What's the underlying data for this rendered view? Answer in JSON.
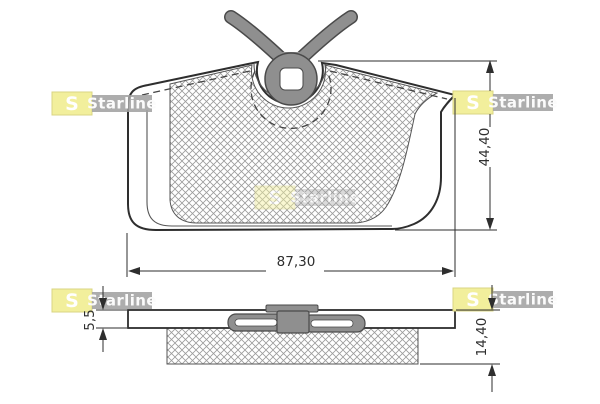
{
  "diagram": {
    "type": "brake-pad technical drawing, front view and side view",
    "dimensions": {
      "width_label": "87,30",
      "height_label": "44,40",
      "backplate_thickness_label": "5,5",
      "total_thickness_label": "14,40"
    },
    "brand": {
      "initial": "S",
      "name": "Starline"
    },
    "colors": {
      "accent-yellow": "#f2ef9c",
      "accent-yellow-border": "#d9d483",
      "watermark-band": "#a2a2a2",
      "part-gray": "#8f8f8f",
      "line-dark": "#2e2e2e",
      "line-mid": "#555555",
      "hatch": "#9b9b9b",
      "background": "#ffffff"
    }
  }
}
